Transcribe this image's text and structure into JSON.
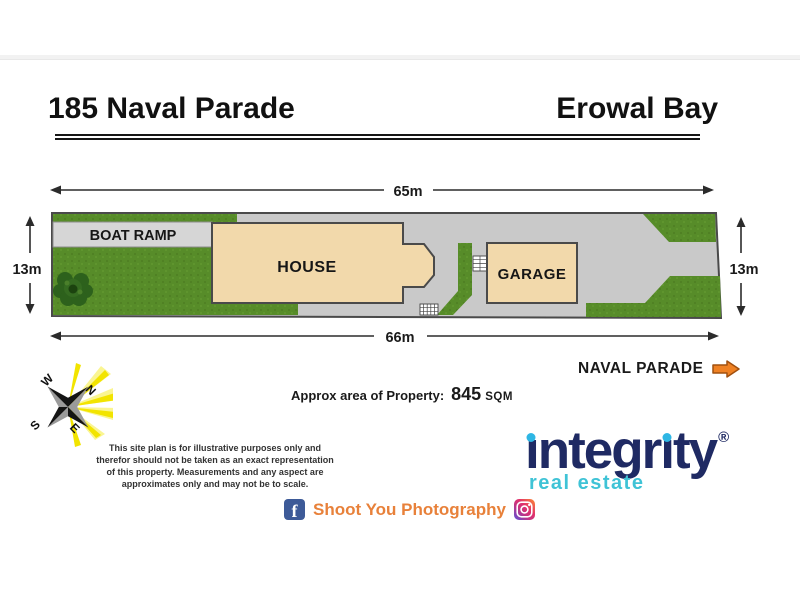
{
  "header": {
    "address": "185 Naval Parade",
    "suburb": "Erowal Bay"
  },
  "plan": {
    "labels": {
      "boat_ramp": "BOAT RAMP",
      "house": "HOUSE",
      "garage": "GARAGE"
    },
    "dimensions": {
      "top": "65m",
      "bottom": "66m",
      "left": "13m",
      "right": "13m"
    },
    "compass": {
      "n": "N",
      "e": "E",
      "s": "S",
      "w": "W"
    },
    "street_label": "NAVAL PARADE",
    "area_prefix": "Approx area of Property:",
    "area_value": "845",
    "area_unit": "SQM",
    "colors": {
      "grass": "#578c29",
      "driveway": "#c9c9c9",
      "boat_ramp": "#d6d6d6",
      "building": "#f2d9ab",
      "street_arrow": "#ef8123"
    }
  },
  "disclaimer": {
    "lines": [
      "This site plan is for illustrative purposes only and",
      "therefor should not be taken as an exact representation",
      "of this property. Measurements and any aspect are",
      "approximates only and may not be to scale."
    ]
  },
  "branding": {
    "name": "integrity",
    "logo_letters": [
      "ı",
      "n",
      "t",
      "e",
      "g",
      "r",
      "ı",
      "t",
      "y"
    ],
    "registered": "®",
    "tagline": "real estate",
    "navy": "#1f2a63",
    "cyan": "#2eb6e4"
  },
  "footer": {
    "facebook_f": "f",
    "credit": "Shoot You Photography"
  }
}
